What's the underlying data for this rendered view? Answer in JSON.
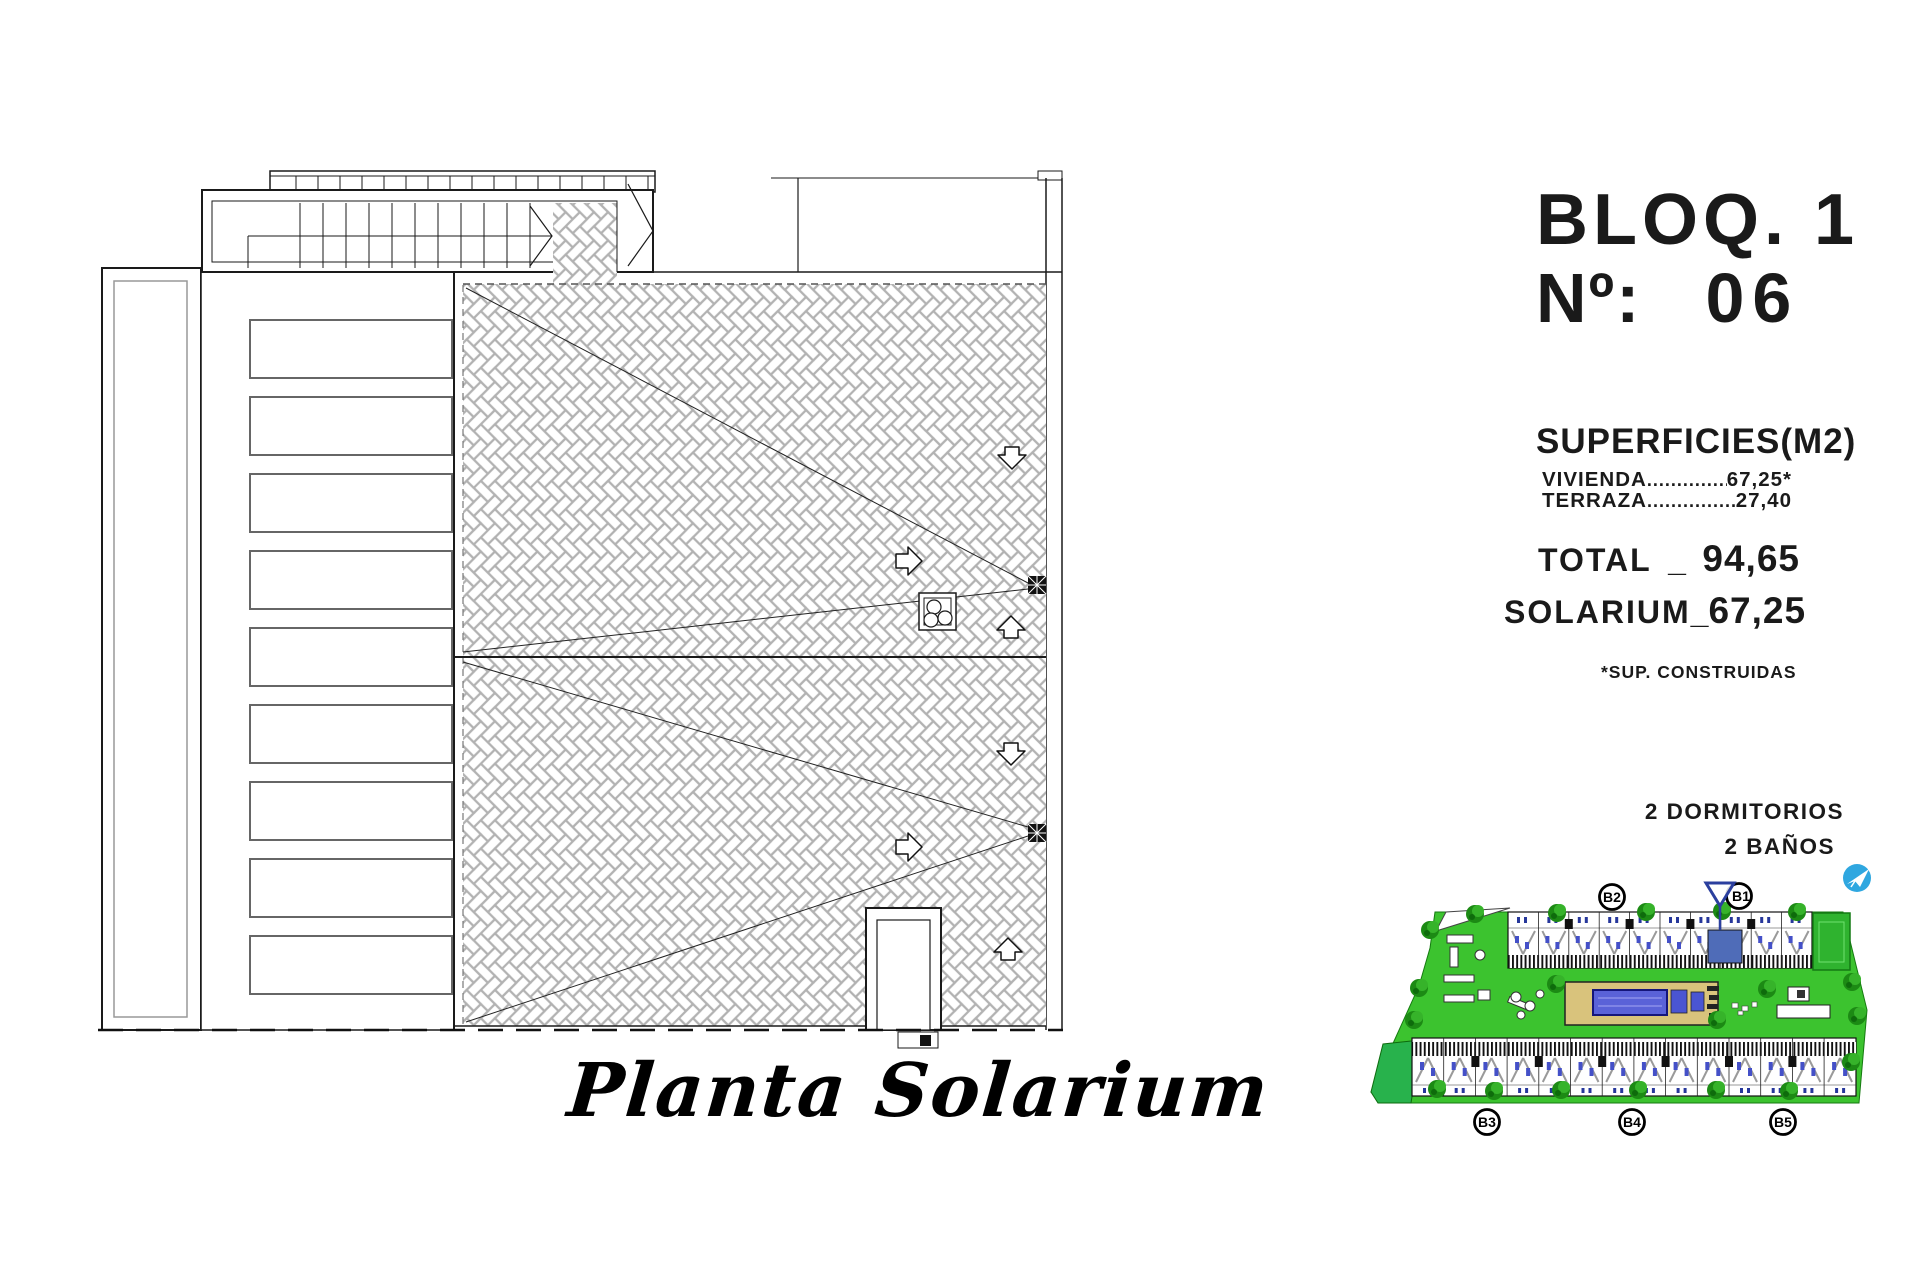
{
  "title_panel": {
    "block": "BLOQ. 1",
    "number_label": "Nº:",
    "number_value": "06"
  },
  "superficies": {
    "title": "SUPERFICIES(M2)",
    "rows": [
      {
        "label": "VIVIENDA",
        "dots": "....................",
        "value": "67,25*"
      },
      {
        "label": "TERRAZA",
        "dots": "...................",
        "value": "27,40"
      }
    ],
    "total": {
      "label": "TOTAL",
      "sep": "_",
      "value": "94,65"
    },
    "solarium": {
      "label": "SOLARIUM",
      "sep": "_",
      "value": "67,25"
    },
    "footnote": "*SUP. CONSTRUIDAS"
  },
  "features": {
    "bedrooms": "2 DORMITORIOS",
    "bathrooms": "2 BAÑOS"
  },
  "caption": "Planta Solarium",
  "site_plan": {
    "markers": {
      "b1": "B1",
      "b2": "B2",
      "b3": "B3",
      "b4": "B4",
      "b5": "B5"
    }
  },
  "colors": {
    "site_green": "#3cc32f",
    "tree_green": "#1d8a15",
    "pool_blue": "#5a62d8",
    "deck_sand": "#d9c37c",
    "unit_highlight": "#4f6cb8",
    "flag_blue": "#2b3f9e",
    "logo_blue": "#2fa7e0",
    "hatch_gray": "#b2b2b2"
  }
}
